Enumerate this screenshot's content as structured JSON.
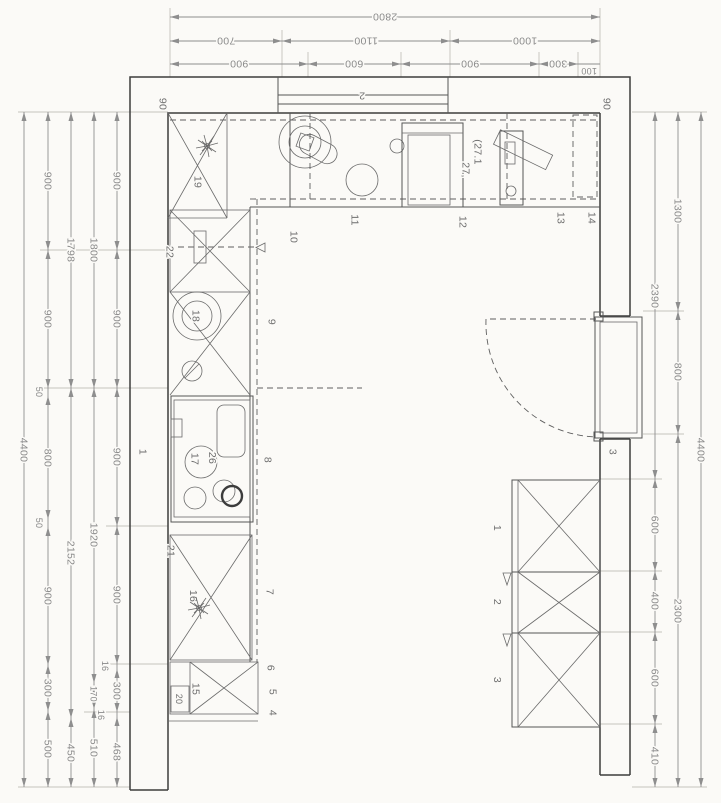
{
  "dims": {
    "top": {
      "total": "2800",
      "row2": [
        "700",
        "1100",
        "1000"
      ],
      "row3": [
        "900",
        "600",
        "900",
        "300"
      ],
      "inset": "100"
    },
    "left": {
      "overall": "4400",
      "chain_a": [
        "900",
        "900",
        "50",
        "800",
        "50",
        "900",
        "300",
        "500"
      ],
      "chain_b": [
        "1798",
        "2152",
        "450"
      ],
      "chain_c": [
        "1800",
        "1920",
        "170",
        "510"
      ],
      "chain_d": [
        "900",
        "900",
        "900",
        "900",
        "16",
        "300",
        "16",
        "468"
      ]
    },
    "right": {
      "chain_a": [
        "2390",
        "600",
        "400",
        "600",
        "410"
      ],
      "chain_b": [
        "1300",
        "800",
        "2300"
      ],
      "overall": "4400"
    }
  },
  "plan": {
    "window_label": "2",
    "offset_left": "90",
    "offset_right": "90",
    "wall_label": "1",
    "door_label": "3",
    "note_a": "27,",
    "note_b": "(27.1",
    "top_run": {
      "corner_cabinet": "19",
      "p10": "10",
      "p11": "11",
      "p12": "12",
      "p13": "13",
      "p14": "14"
    },
    "left_run": {
      "c22": "22",
      "c18": "18",
      "c17": "17",
      "c26": "26",
      "c21": "21",
      "c16": "16",
      "c15": "15",
      "c20": "20",
      "p9": "9",
      "p8": "8",
      "p7": "7",
      "p6": "6",
      "p5": "5",
      "p4": "4"
    },
    "island": {
      "s1": "1",
      "s2": "2",
      "s3": "3"
    }
  }
}
